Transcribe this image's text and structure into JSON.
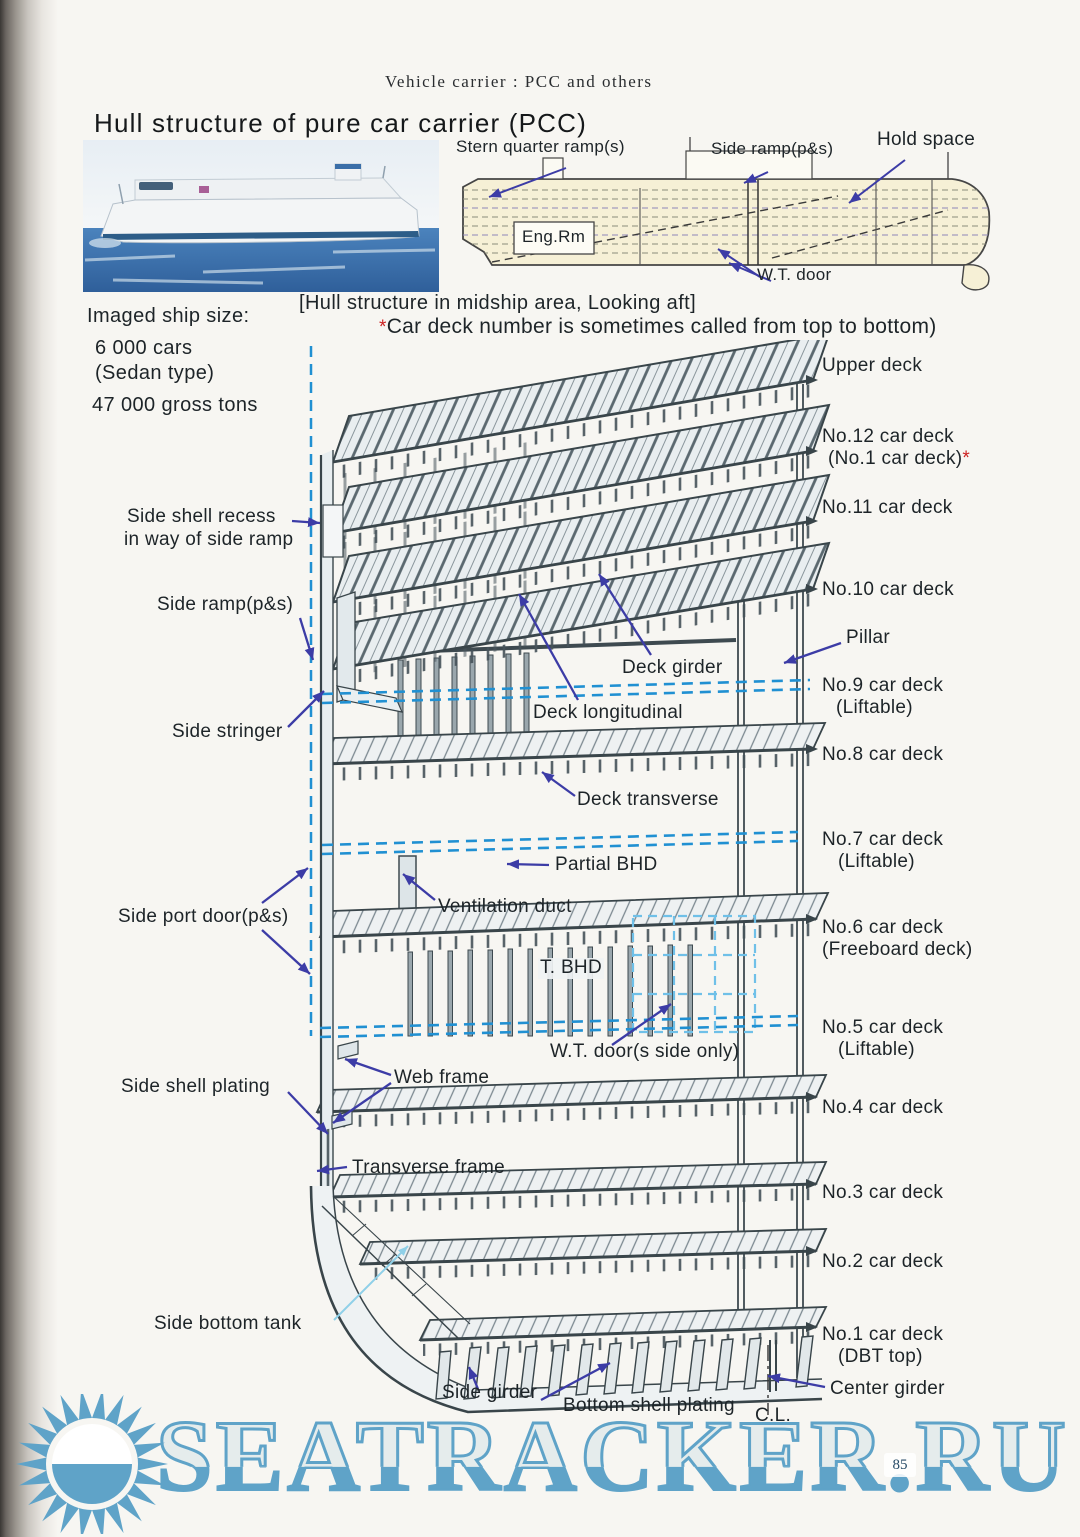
{
  "header": "Vehicle carrier :  PCC and others",
  "title": "Hull structure of pure car carrier (PCC)",
  "ship_size": {
    "heading": "Imaged ship size:",
    "cars": "6 000 cars",
    "type": "(Sedan type)",
    "tonnage": "47 000 gross tons"
  },
  "profile_labels": {
    "stern_quarter_ramp": "Stern quarter ramp(s)",
    "side_ramp": "Side ramp(p&s)",
    "hold_space": "Hold space",
    "eng_rm": "Eng.Rm",
    "wt_door": "W.T. door"
  },
  "caption": {
    "line1": "[Hull structure in midship area, Looking aft]",
    "star": "*",
    "line2": "Car deck number is sometimes called from top to bottom)"
  },
  "right_labels": [
    {
      "text": "Upper deck"
    },
    {
      "text": "No.12 car deck",
      "sub": "(No.1 car deck)",
      "star": "*"
    },
    {
      "text": "No.11 car deck"
    },
    {
      "text": "No.10 car deck"
    },
    {
      "text": "Pillar"
    },
    {
      "text": "No.9 car deck",
      "sub": "(Liftable)"
    },
    {
      "text": "No.8 car deck"
    },
    {
      "text": "No.7 car deck",
      "sub": "(Liftable)"
    },
    {
      "text": "No.6 car deck",
      "sub": "(Freeboard deck)"
    },
    {
      "text": "No.5 car deck",
      "sub": "(Liftable)"
    },
    {
      "text": "No.4 car deck"
    },
    {
      "text": "No.3 car deck"
    },
    {
      "text": "No.2 car deck"
    },
    {
      "text": "No.1 car deck",
      "sub": "(DBT top)"
    }
  ],
  "left_labels": [
    {
      "text": "Side shell recess",
      "sub": "in way of side ramp"
    },
    {
      "text": "Side ramp(p&s)"
    },
    {
      "text": "Side stringer"
    },
    {
      "text": "Side port door(p&s)"
    },
    {
      "text": "Side shell plating"
    },
    {
      "text": "Side bottom tank"
    }
  ],
  "inner_labels": [
    {
      "text": "Deck girder"
    },
    {
      "text": "Deck longitudinal"
    },
    {
      "text": "Deck transverse"
    },
    {
      "text": "Partial BHD"
    },
    {
      "text": "Ventilation duct"
    },
    {
      "text": "T. BHD"
    },
    {
      "text": "W.T. door(s side only)"
    },
    {
      "text": "Web frame"
    },
    {
      "text": "Transverse frame"
    }
  ],
  "bottom_labels": [
    {
      "text": "Side girder"
    },
    {
      "text": "Bottom shell plating"
    },
    {
      "text": "C.L."
    },
    {
      "text": "Center girder"
    }
  ],
  "watermark": {
    "text": "SEATRACKER.RU",
    "color": "#5fa3c8"
  },
  "page_number": "85",
  "colors": {
    "arrow": "#3c3ca6",
    "liftable_dash": "#2090d2",
    "wt_grid_dash": "#6fc0e8",
    "note_star": "#cc2222",
    "profile_fill": "#f6f0d6"
  }
}
